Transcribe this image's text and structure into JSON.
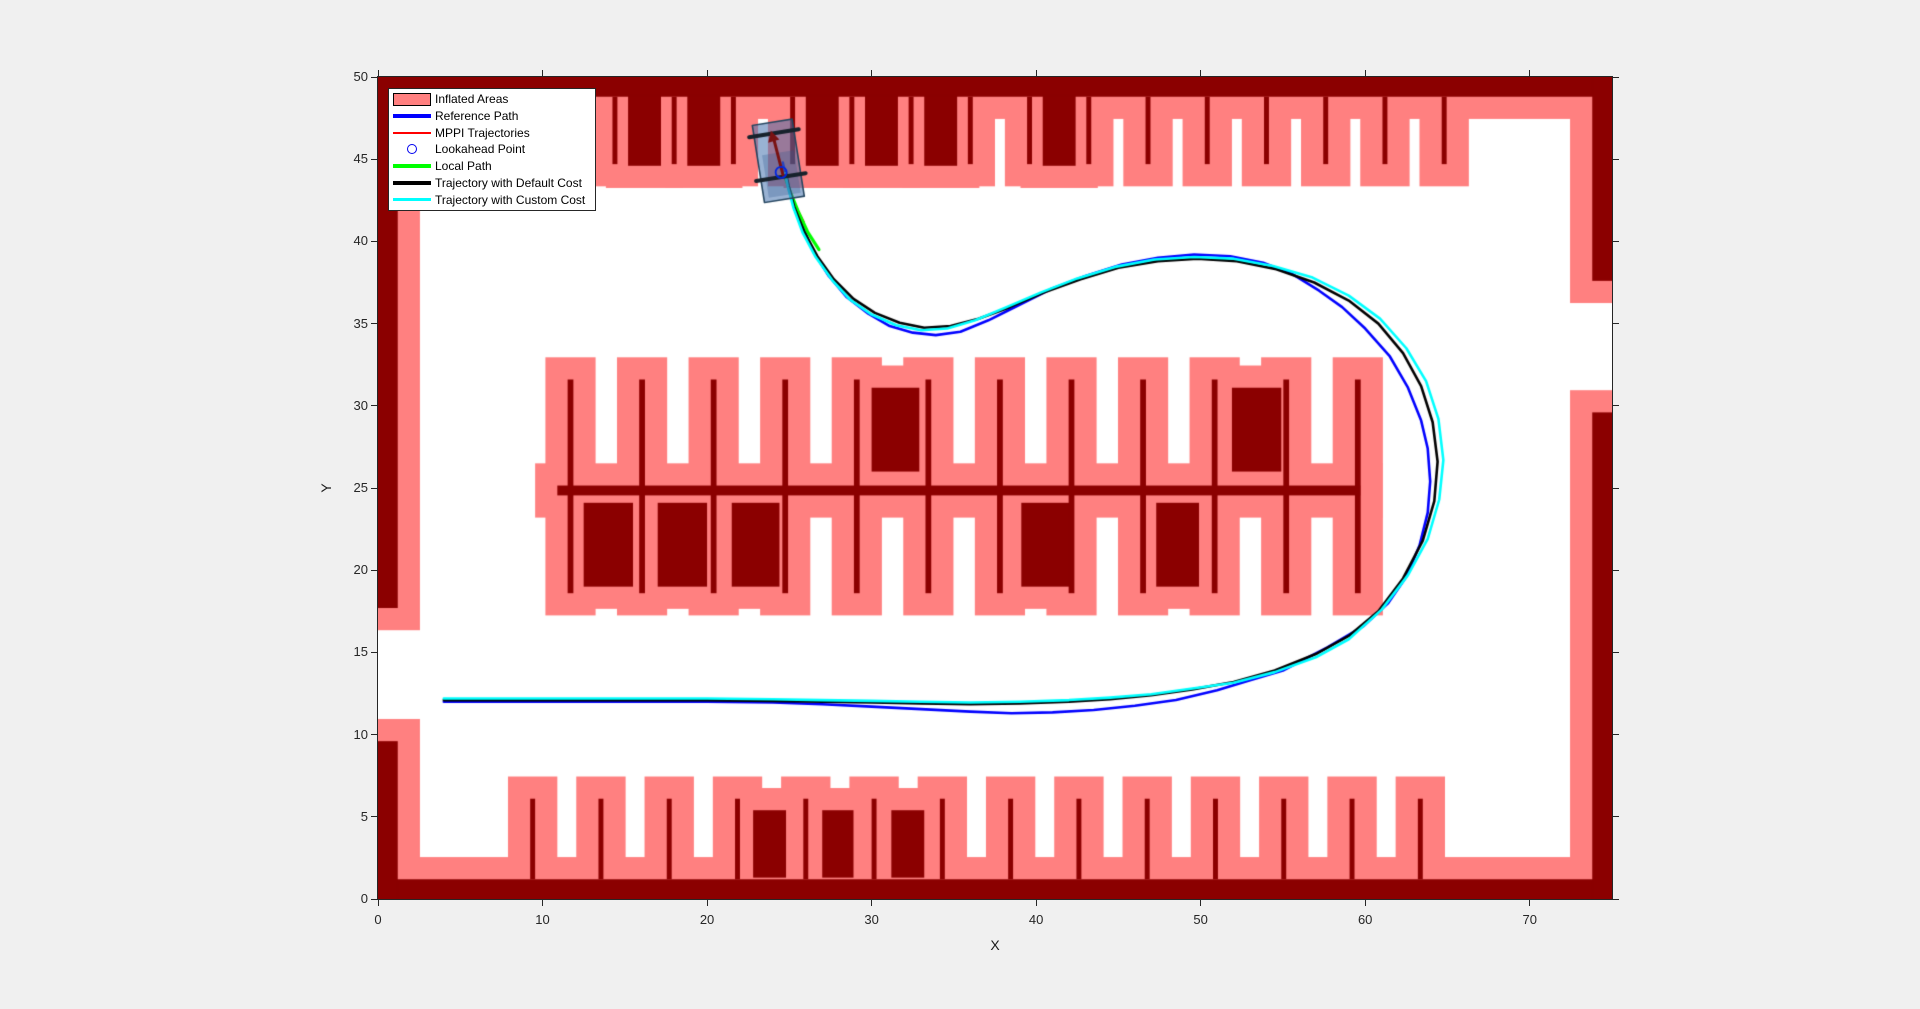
{
  "figure": {
    "background": "#F0F0F0",
    "plot_background": "#FFFFFF",
    "axis_color": "#262626"
  },
  "axes": {
    "xlabel": "X",
    "ylabel": "Y",
    "xlim": [
      0,
      75
    ],
    "ylim": [
      0,
      50
    ],
    "xticks": [
      0,
      10,
      20,
      30,
      40,
      50,
      60,
      70
    ],
    "yticks": [
      0,
      5,
      10,
      15,
      20,
      25,
      30,
      35,
      40,
      45,
      50
    ]
  },
  "legend": {
    "items": [
      {
        "label": "Inflated Areas",
        "type": "patch",
        "color": "#FF8080"
      },
      {
        "label": "Reference Path",
        "type": "line",
        "color": "#0000FF",
        "thickness": 3.5
      },
      {
        "label": "MPPI Trajectories",
        "type": "line",
        "color": "#FF0000",
        "thickness": 1.5
      },
      {
        "label": "Lookahead Point",
        "type": "circle",
        "color": "#0000F0"
      },
      {
        "label": "Local Path",
        "type": "line",
        "color": "#00FF00",
        "thickness": 3.5
      },
      {
        "label": "Trajectory with Default Cost",
        "type": "line",
        "color": "#000000",
        "thickness": 3.5
      },
      {
        "label": "Trajectory with Custom Cost",
        "type": "line",
        "color": "#00FFFF",
        "thickness": 3.5
      }
    ]
  },
  "chart_data": {
    "type": "line",
    "title": "",
    "xlabel": "X",
    "ylabel": "Y",
    "xlim": [
      0,
      75
    ],
    "ylim": [
      0,
      50
    ],
    "grid": false,
    "legend_position": "top-left",
    "map": {
      "inflation_radius": 1.35,
      "colors": {
        "obstacle": "#8B0000",
        "inflated": "#FF8080"
      },
      "walls": [
        [
          0,
          48.8,
          75,
          1.2
        ],
        [
          0,
          0,
          75,
          1.2
        ],
        [
          0,
          0,
          1.2,
          9.6
        ],
        [
          0,
          17.7,
          1.2,
          32.3
        ],
        [
          73.8,
          0,
          1.2,
          29.6
        ],
        [
          73.8,
          37.6,
          1.2,
          12.4
        ]
      ],
      "stall_rows": [
        {
          "name": "top",
          "divider_xs": [
            10.8,
            14.4,
            18,
            21.6,
            25.2,
            28.8,
            32.4,
            36,
            39.6,
            43.2,
            46.8,
            50.4,
            54,
            57.6,
            61.2,
            64.8
          ],
          "divider_w": 0.3,
          "divider_y": 44.7,
          "divider_h": 4.1,
          "cars": [
            [
              15.2,
              44.6,
              2,
              4.25
            ],
            [
              18.8,
              44.6,
              2,
              4.25
            ],
            [
              26,
              44.6,
              2,
              4.25
            ],
            [
              29.6,
              44.6,
              2,
              4.25
            ],
            [
              33.2,
              44.6,
              2,
              4.25
            ],
            [
              40.4,
              44.6,
              2,
              4.25
            ]
          ]
        },
        {
          "name": "middle",
          "divider_xs": [
            11.7,
            16.05,
            20.4,
            24.75,
            29.1,
            33.45,
            37.8,
            42.15,
            46.5,
            50.85,
            55.2,
            59.55
          ],
          "divider_w": 0.35,
          "divider_y": 18.6,
          "divider_h": 13.0,
          "spine": [
            10.9,
            24.55,
            48.8,
            0.6
          ],
          "cars": [
            [
              30,
              26,
              2.9,
              5.1
            ],
            [
              51.9,
              26,
              3,
              5.1
            ],
            [
              12.5,
              19,
              3,
              5.1
            ],
            [
              17,
              19,
              3,
              5.1
            ],
            [
              21.5,
              19,
              2.9,
              5.1
            ],
            [
              39.1,
              19,
              2.9,
              5.1
            ],
            [
              47.3,
              19,
              2.6,
              5.1
            ]
          ]
        },
        {
          "name": "bottom",
          "divider_xs": [
            9.4,
            13.55,
            17.7,
            21.85,
            26,
            30.15,
            34.3,
            38.45,
            42.6,
            46.75,
            50.9,
            55.05,
            59.2,
            63.35
          ],
          "divider_w": 0.3,
          "divider_y": 1.2,
          "divider_h": 4.9,
          "cars": [
            [
              22.8,
              1.3,
              2,
              4.1
            ],
            [
              27,
              1.3,
              1.9,
              4.1
            ],
            [
              31.2,
              1.3,
              2,
              4.1
            ]
          ]
        }
      ]
    },
    "series": [
      {
        "name": "Reference Path",
        "color": "#0000FF",
        "width": 2.6,
        "points": [
          [
            4,
            12.0
          ],
          [
            8,
            12.0
          ],
          [
            12,
            12.0
          ],
          [
            16,
            12.0
          ],
          [
            20,
            12.0
          ],
          [
            24,
            11.95
          ],
          [
            27,
            11.85
          ],
          [
            30,
            11.7
          ],
          [
            33,
            11.55
          ],
          [
            36,
            11.4
          ],
          [
            38.5,
            11.3
          ],
          [
            41,
            11.35
          ],
          [
            43.5,
            11.5
          ],
          [
            46,
            11.75
          ],
          [
            48.5,
            12.1
          ],
          [
            51,
            12.7
          ],
          [
            53,
            13.3
          ],
          [
            55,
            13.9
          ],
          [
            57.7,
            15.3
          ],
          [
            59.9,
            16.6
          ],
          [
            61.4,
            18.0
          ],
          [
            62.5,
            19.6
          ],
          [
            63.3,
            21.5
          ],
          [
            63.8,
            23.5
          ],
          [
            63.95,
            25.4
          ],
          [
            63.8,
            27.4
          ],
          [
            63.4,
            29.1
          ],
          [
            62.6,
            31.1
          ],
          [
            61.5,
            33.0
          ],
          [
            60.0,
            34.7
          ],
          [
            58.6,
            36.0
          ],
          [
            57.2,
            37.0
          ],
          [
            55.6,
            38.0
          ],
          [
            53.8,
            38.7
          ],
          [
            51.8,
            39.1
          ],
          [
            49.6,
            39.2
          ],
          [
            47.4,
            39.0
          ],
          [
            45.2,
            38.6
          ],
          [
            43.0,
            37.9
          ],
          [
            40.9,
            37.1
          ],
          [
            38.9,
            36.1
          ],
          [
            37.1,
            35.2
          ],
          [
            35.4,
            34.5
          ],
          [
            33.9,
            34.3
          ],
          [
            32.5,
            34.45
          ],
          [
            31.1,
            34.85
          ],
          [
            29.8,
            35.6
          ],
          [
            28.5,
            36.6
          ],
          [
            27.4,
            37.9
          ],
          [
            26.5,
            39.3
          ],
          [
            25.8,
            40.9
          ],
          [
            25.2,
            42.5
          ],
          [
            24.8,
            43.9
          ],
          [
            24.6,
            44.8
          ]
        ]
      },
      {
        "name": "MPPI Trajectories",
        "color": "#FF0000",
        "width": 1.2,
        "points": [
          [
            24.4,
            44.7
          ],
          [
            24.8,
            43.6
          ],
          [
            25.3,
            42.4
          ],
          [
            25.9,
            41.2
          ]
        ]
      },
      {
        "name": "Local Path",
        "color": "#00FF00",
        "width": 3.2,
        "points": [
          [
            24.75,
            43.9
          ],
          [
            25.1,
            42.9
          ],
          [
            25.55,
            41.8
          ],
          [
            26.1,
            40.6
          ],
          [
            26.8,
            39.5
          ]
        ]
      },
      {
        "name": "Trajectory with Default Cost",
        "color": "#000000",
        "width": 2.6,
        "points": [
          [
            4,
            12.1
          ],
          [
            8,
            12.1
          ],
          [
            12,
            12.1
          ],
          [
            16,
            12.1
          ],
          [
            20,
            12.1
          ],
          [
            24,
            12.05
          ],
          [
            27,
            12.0
          ],
          [
            30,
            11.95
          ],
          [
            33,
            11.9
          ],
          [
            36,
            11.85
          ],
          [
            39,
            11.9
          ],
          [
            42,
            12.0
          ],
          [
            44.5,
            12.15
          ],
          [
            47,
            12.4
          ],
          [
            49.5,
            12.75
          ],
          [
            52,
            13.2
          ],
          [
            54.5,
            13.9
          ],
          [
            57,
            14.9
          ],
          [
            59,
            16.0
          ],
          [
            60.8,
            17.5
          ],
          [
            62.3,
            19.5
          ],
          [
            63.5,
            21.8
          ],
          [
            64.2,
            24.2
          ],
          [
            64.4,
            26.6
          ],
          [
            64.1,
            29.0
          ],
          [
            63.4,
            31.2
          ],
          [
            62.3,
            33.2
          ],
          [
            60.8,
            35.0
          ],
          [
            59.0,
            36.4
          ],
          [
            56.9,
            37.5
          ],
          [
            54.6,
            38.3
          ],
          [
            52.2,
            38.8
          ],
          [
            49.8,
            38.95
          ],
          [
            47.4,
            38.8
          ],
          [
            45.0,
            38.4
          ],
          [
            42.7,
            37.7
          ],
          [
            40.5,
            36.9
          ],
          [
            38.4,
            36.0
          ],
          [
            36.5,
            35.3
          ],
          [
            34.8,
            34.85
          ],
          [
            33.2,
            34.75
          ],
          [
            31.7,
            35.05
          ],
          [
            30.2,
            35.65
          ],
          [
            28.9,
            36.5
          ],
          [
            27.7,
            37.7
          ],
          [
            26.7,
            39.1
          ],
          [
            25.9,
            40.6
          ],
          [
            25.3,
            42.1
          ],
          [
            24.95,
            43.4
          ],
          [
            24.8,
            44.2
          ]
        ]
      },
      {
        "name": "Trajectory with Custom Cost",
        "color": "#00FFFF",
        "width": 2.6,
        "points": [
          [
            4,
            12.2
          ],
          [
            8,
            12.2
          ],
          [
            12,
            12.2
          ],
          [
            16,
            12.2
          ],
          [
            20,
            12.2
          ],
          [
            24,
            12.15
          ],
          [
            27,
            12.1
          ],
          [
            30,
            12.05
          ],
          [
            33,
            12.0
          ],
          [
            36,
            11.95
          ],
          [
            39,
            12.0
          ],
          [
            42,
            12.1
          ],
          [
            44.5,
            12.25
          ],
          [
            47,
            12.45
          ],
          [
            49.5,
            12.8
          ],
          [
            52,
            13.15
          ],
          [
            54.5,
            13.8
          ],
          [
            57,
            14.7
          ],
          [
            59,
            15.8
          ],
          [
            61,
            17.6
          ],
          [
            62.6,
            19.7
          ],
          [
            63.8,
            21.9
          ],
          [
            64.5,
            24.3
          ],
          [
            64.75,
            26.7
          ],
          [
            64.45,
            29.2
          ],
          [
            63.7,
            31.5
          ],
          [
            62.5,
            33.5
          ],
          [
            60.9,
            35.3
          ],
          [
            59.0,
            36.7
          ],
          [
            56.8,
            37.8
          ],
          [
            54.4,
            38.5
          ],
          [
            52.0,
            38.95
          ],
          [
            49.6,
            39.05
          ],
          [
            47.2,
            38.9
          ],
          [
            44.8,
            38.45
          ],
          [
            42.5,
            37.75
          ],
          [
            40.3,
            36.9
          ],
          [
            38.2,
            36.0
          ],
          [
            36.3,
            35.2
          ],
          [
            34.6,
            34.7
          ],
          [
            33.0,
            34.6
          ],
          [
            31.5,
            34.9
          ],
          [
            30.0,
            35.55
          ],
          [
            28.7,
            36.45
          ],
          [
            27.6,
            37.65
          ],
          [
            26.6,
            39.05
          ],
          [
            25.8,
            40.55
          ],
          [
            25.25,
            42.05
          ],
          [
            24.9,
            43.35
          ],
          [
            24.75,
            44.15
          ]
        ]
      }
    ],
    "vehicle": {
      "cx": 24.33,
      "cy": 44.9,
      "length": 4.75,
      "width": 2.45,
      "lean_deg": 9,
      "body_fill": "rgba(70,115,175,0.55)",
      "body_stroke": "#24455F",
      "inner_fill": "rgba(45,85,140,0.28)",
      "axle_color": "#17222C",
      "axle_offsets": [
        1.7,
        -1.0
      ],
      "axle_overhang": 0.3,
      "arrow_color": "#7A1212"
    },
    "lookahead": {
      "x": 24.5,
      "y": 44.2,
      "radius_px": 5.5,
      "color": "#0026E0"
    }
  }
}
